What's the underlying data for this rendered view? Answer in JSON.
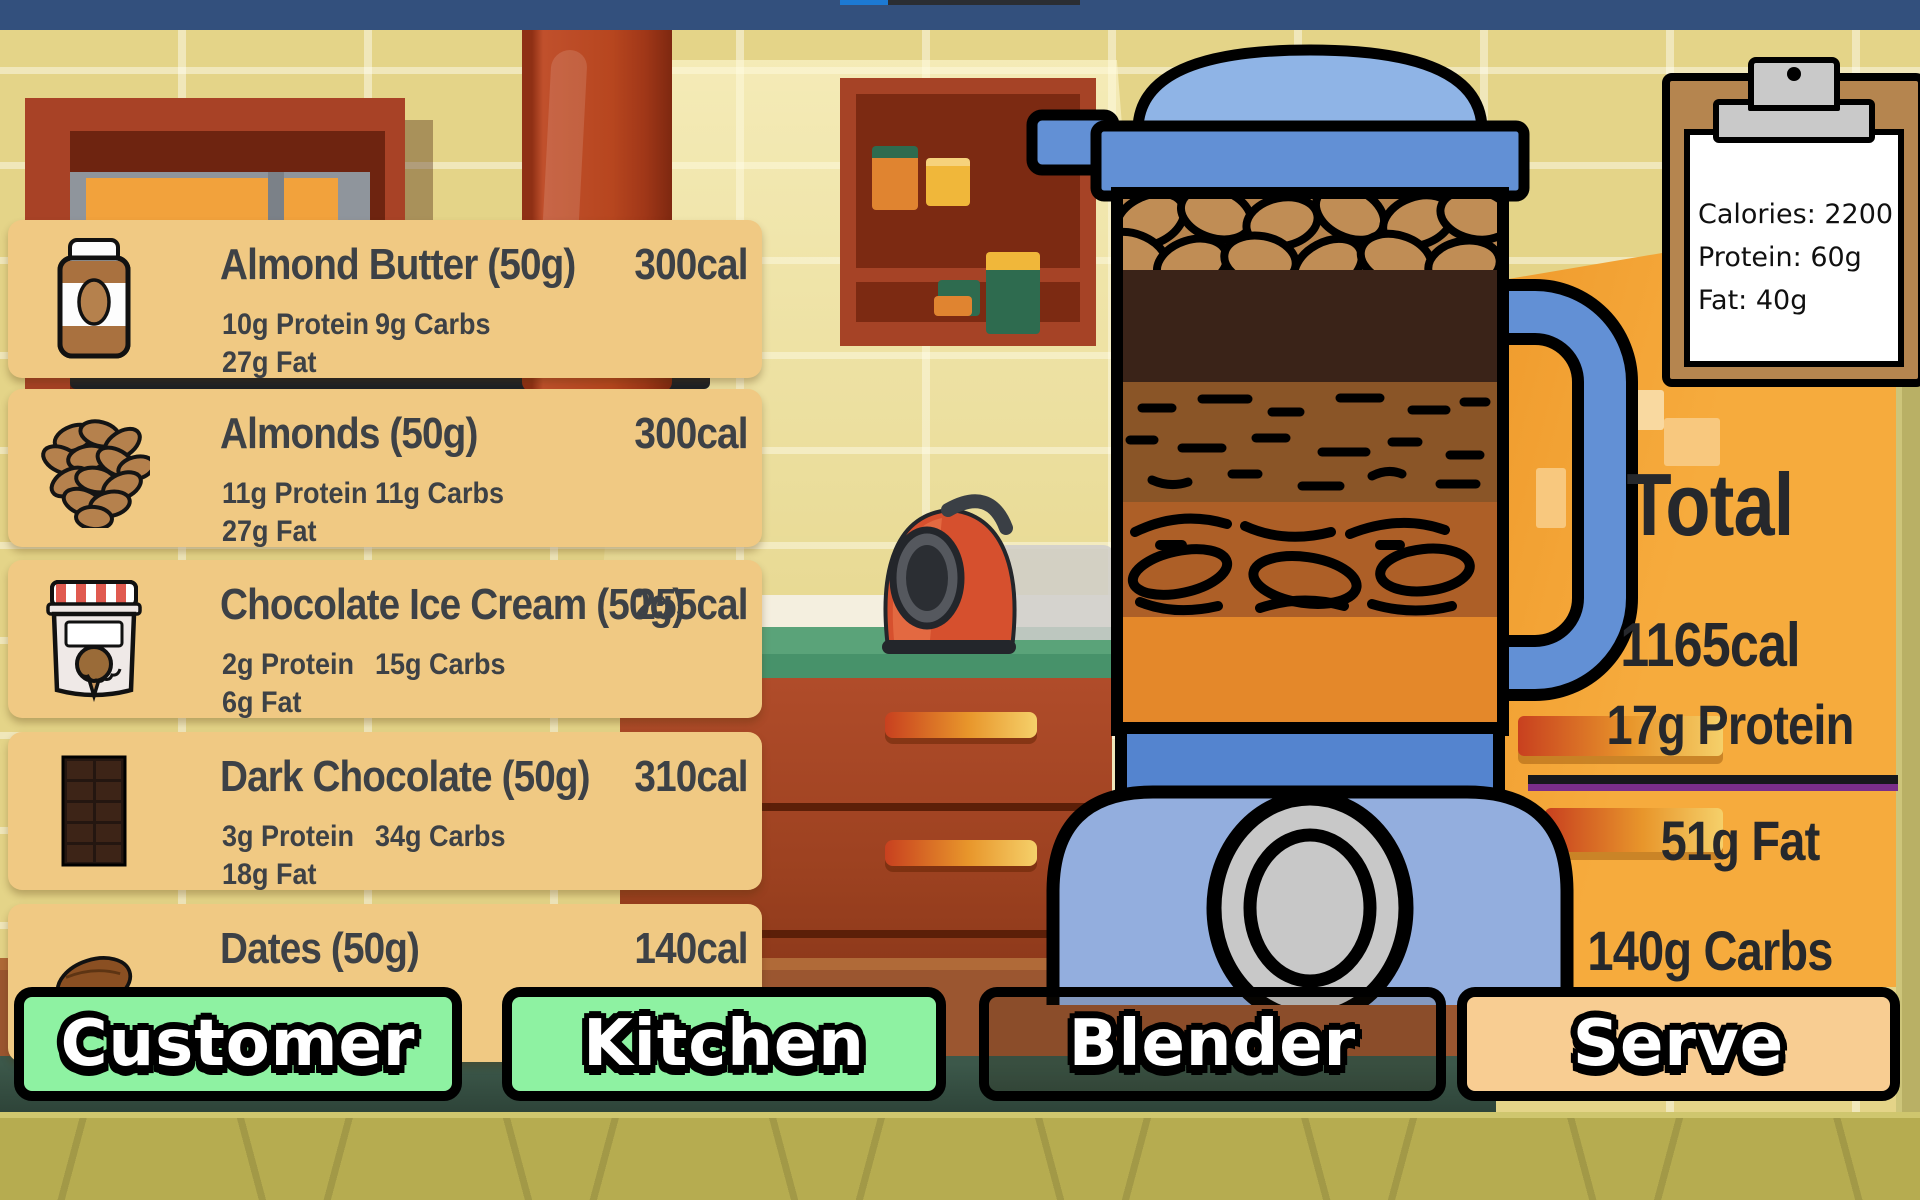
{
  "colors": {
    "top_bar": "#33507d",
    "card_bg": "#f0c983",
    "button_green": "#8ef2a2",
    "button_peach": "#f8cd92",
    "box_orange": "#f6ab3d",
    "blender_blue": "#6290d5"
  },
  "clipboard": {
    "calories": "Calories: 2200",
    "protein": "Protein: 60g",
    "fat": "Fat: 40g"
  },
  "ingredients": [
    {
      "name": "Almond Butter (50g)",
      "calories": "300cal",
      "protein": "10g Protein",
      "carbs": "9g Carbs",
      "fat": "27g Fat",
      "icon": "almond-butter-jar"
    },
    {
      "name": "Almonds (50g)",
      "calories": "300cal",
      "protein": "11g Protein",
      "carbs": "11g Carbs",
      "fat": "27g Fat",
      "icon": "almonds-pile"
    },
    {
      "name": "Chocolate Ice Cream (50g)",
      "calories": "255cal",
      "protein": "2g Protein",
      "carbs": "15g Carbs",
      "fat": "6g Fat",
      "icon": "ice-cream-tub"
    },
    {
      "name": "Dark Chocolate (50g)",
      "calories": "310cal",
      "protein": "3g Protein",
      "carbs": "34g Carbs",
      "fat": "18g Fat",
      "icon": "chocolate-bar"
    },
    {
      "name": "Dates (50g)",
      "calories": "140cal",
      "icon": "date-fruit"
    }
  ],
  "totals": {
    "title": "Total",
    "calories": "1165cal",
    "protein": "17g Protein",
    "fat": "51g Fat",
    "carbs": "140g Carbs"
  },
  "nav": {
    "customer": "Customer",
    "kitchen": "Kitchen",
    "blender": "Blender",
    "serve": "Serve"
  },
  "blender": {
    "contents": [
      "almonds",
      "dark-chocolate",
      "almond-butter",
      "dates",
      "orange-liquid"
    ]
  }
}
